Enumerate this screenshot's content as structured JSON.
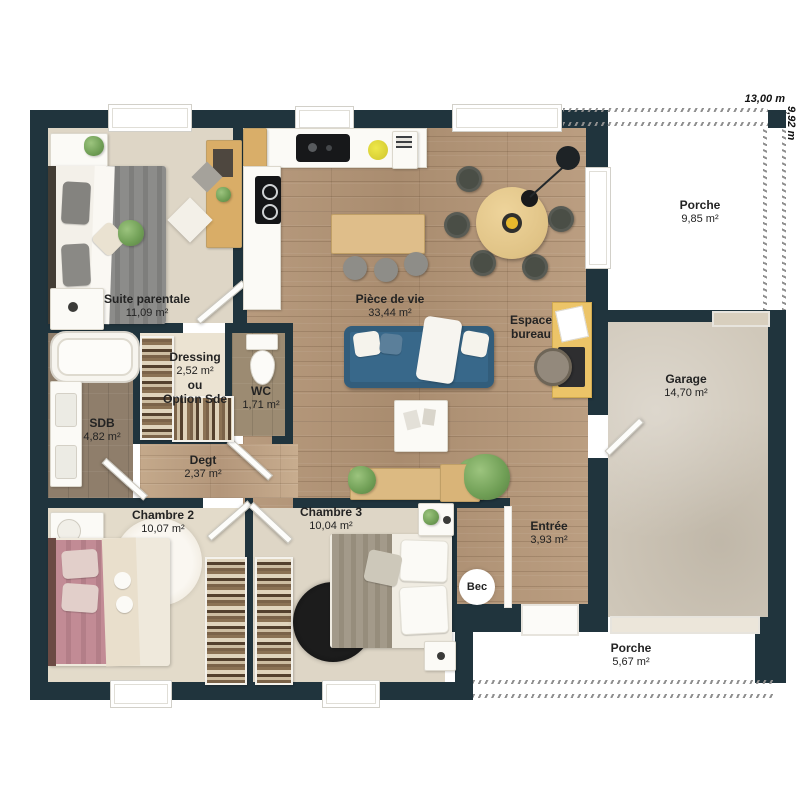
{
  "dimensions": {
    "width_label": "13,00 m",
    "depth_label": "9,92 m"
  },
  "rooms": {
    "suite_parentale": {
      "name": "Suite parentale",
      "area": "11,09 m²"
    },
    "piece_de_vie": {
      "name": "Pièce de vie",
      "area": "33,44 m²"
    },
    "espace_bureau": {
      "name": "Espace bureau"
    },
    "porche_haut": {
      "name": "Porche",
      "area": "9,85 m²"
    },
    "garage": {
      "name": "Garage",
      "area": "14,70 m²"
    },
    "dressing": {
      "name": "Dressing",
      "area": "2,52 m²",
      "note_line1": "ou",
      "note_line2": "Option Sde"
    },
    "wc": {
      "name": "WC",
      "area": "1,71 m²"
    },
    "sdb": {
      "name": "SDB",
      "area": "4,82 m²"
    },
    "degagement": {
      "name": "Degt",
      "area": "2,37 m²"
    },
    "chambre_2": {
      "name": "Chambre 2",
      "area": "10,07 m²"
    },
    "chambre_3": {
      "name": "Chambre 3",
      "area": "10,04 m²"
    },
    "entree": {
      "name": "Entrée",
      "area": "3,93 m²"
    },
    "porche_bas": {
      "name": "Porche",
      "area": "5,67 m²"
    }
  },
  "annotations": {
    "bec": "Bec"
  },
  "colors": {
    "wall": "#20343d",
    "floor-wood": "#b3957a",
    "floor-cream": "#ded6c6",
    "floor-cream2": "#e3dbca",
    "floor-dressing": "#ebe3d2",
    "floor-sdb": "#8f7e6b",
    "floor-wc": "#9c8b72",
    "floor-garage": "#d0c8ba",
    "sofa": "#38688a",
    "wood-furniture": "#dcb97e",
    "desk": "#ecc468",
    "bed-pink": "#c28b95",
    "dash": "#8f8f8f",
    "label": "#232323"
  }
}
